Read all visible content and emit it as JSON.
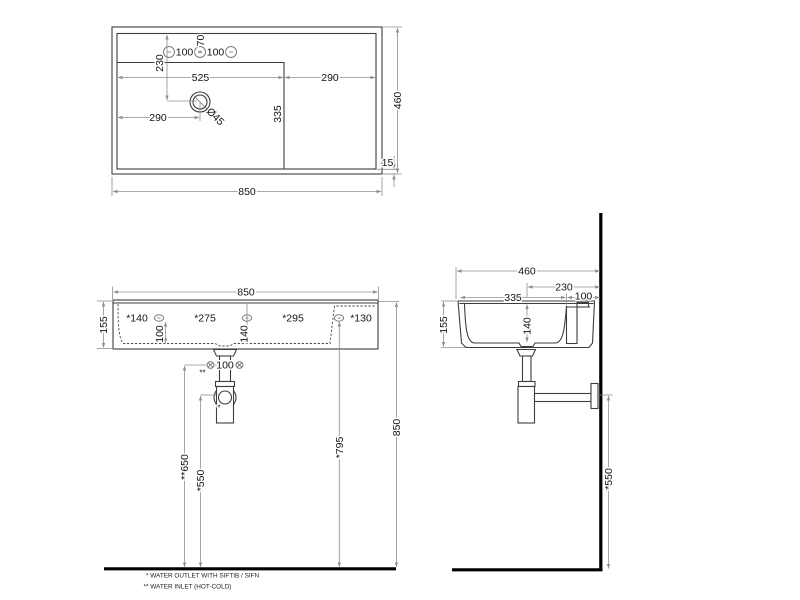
{
  "colors": {
    "object_line": "#3d3d3d",
    "dimension_line": "#8f8f8f",
    "heavy_line": "#000000",
    "text": "#141414",
    "background": "#ffffff"
  },
  "top_view": {
    "overall_width": "850",
    "overall_depth": "460",
    "rim_thickness": "15",
    "tap_pitch_left": "100",
    "tap_pitch_right": "100",
    "tap_offset": "70",
    "bowl_front_offset": "230",
    "bowl_width": "525",
    "deck_width": "290",
    "drain_from_left": "290",
    "bowl_length": "335",
    "drain_diameter": "Ø45"
  },
  "front_view": {
    "overall_width": "850",
    "height": "155",
    "hole_dim_1": "*140",
    "hole_dim_2": "*275",
    "hole_dim_3": "*295",
    "hole_dim_4": "*130",
    "hole_drop_left": "100",
    "hole_drop_center": "140",
    "inlet_pitch": "100",
    "inlet_mark": "**",
    "outlet_mark": "*",
    "inlet_height": "**650",
    "outlet_height": "*550",
    "fixing_height": "*795",
    "rim_height": "850"
  },
  "side_view": {
    "overall_depth": "460",
    "drain_to_wall": "230",
    "bowl_depth": "335",
    "back_ledge": "100",
    "height": "155",
    "bowl_inner_height": "140",
    "outlet_height": "*550"
  },
  "notes": {
    "outlet": "* WATER OUTLET WITH SIFTIB / SIFN",
    "inlet": "** WATER INLET  (HOT-COLD)"
  }
}
